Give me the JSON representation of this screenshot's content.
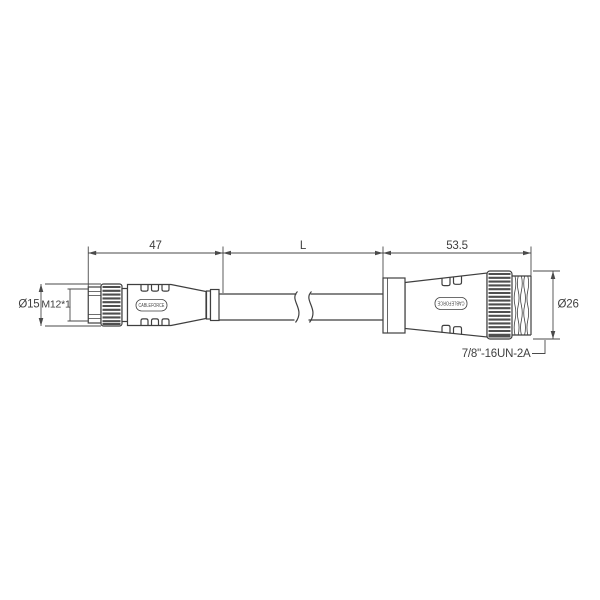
{
  "dims": {
    "left_length": "47",
    "cable_length": "L",
    "right_length": "53.5",
    "left_diameter": "Ø15",
    "left_thread": "M12*1",
    "right_diameter": "Ø26",
    "right_thread_label": "7/8\"-16UN-2A"
  },
  "left_connector": {
    "brand_label": "CABLEFORCE"
  },
  "right_connector": {
    "brand_label": "CABLEFORCE"
  },
  "colors": {
    "background": "#ffffff",
    "line": "#3f3f3f",
    "dimension_line": "#4a4a4a",
    "knurl": "#4f4f4f"
  }
}
